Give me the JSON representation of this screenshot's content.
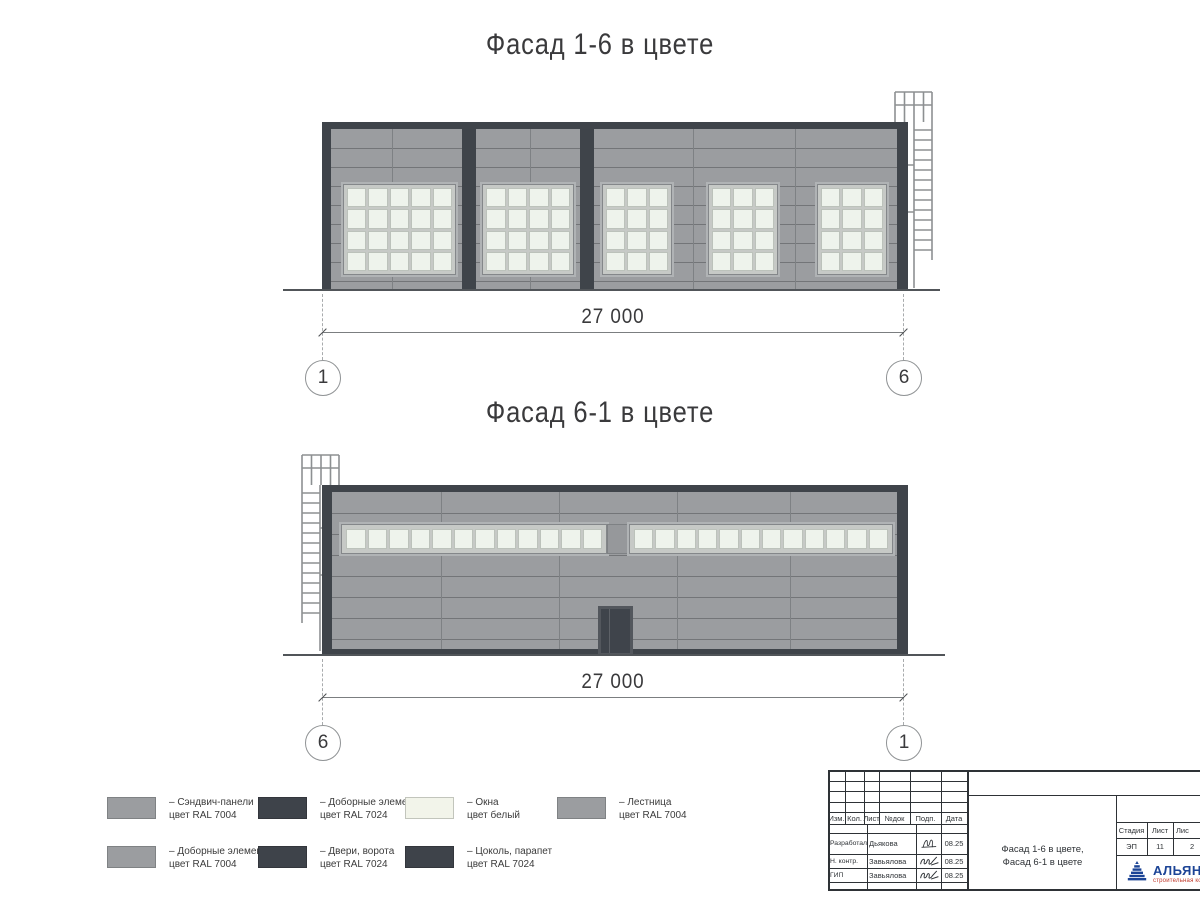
{
  "colors": {
    "ral7004": "#9b9da0",
    "ral7024": "#3f444a",
    "window_white": "#eef3ec",
    "logo_blue": "#1c4496",
    "logo_red": "#c0392b"
  },
  "facades": [
    {
      "title": "Фасад 1-6 в цвете",
      "dimension": "27 000",
      "axis_left": "1",
      "axis_right": "6"
    },
    {
      "title": "Фасад 6-1 в цвете",
      "dimension": "27 000",
      "axis_left": "6",
      "axis_right": "1"
    }
  ],
  "legend": {
    "items": [
      {
        "swatch": "gray",
        "line1": "– Сэндвич-панели",
        "line2": "цвет RAL 7004"
      },
      {
        "swatch": "darksw",
        "line1": "– Доборные элементы",
        "line2": "цвет RAL 7024"
      },
      {
        "swatch": "whitesw",
        "line1": "– Окна",
        "line2": "цвет белый"
      },
      {
        "swatch": "gray",
        "line1": "– Лестница",
        "line2": "цвет RAL 7004"
      },
      {
        "swatch": "gray",
        "line1": "– Доборные элементы",
        "line2": "цвет RAL 7004"
      },
      {
        "swatch": "darksw",
        "line1": "– Двери, ворота",
        "line2": "цвет RAL 7024"
      },
      {
        "swatch": "darksw",
        "line1": "– Цоколь, парапет",
        "line2": "цвет RAL 7024"
      }
    ]
  },
  "title_block": {
    "header_cols": [
      "Изм.",
      "Кол.",
      "Лист",
      "№док",
      "Подп.",
      "Дата"
    ],
    "staff": [
      {
        "role": "Разработал",
        "name": "Дьякова",
        "date": "08.25"
      },
      {
        "role": "Н. контр.",
        "name": "Завьялова",
        "date": "08.25"
      },
      {
        "role": "ГИП",
        "name": "Завьялова",
        "date": "08.25"
      }
    ],
    "doc_title_line1": "Фасад 1-6 в цвете,",
    "doc_title_line2": "Фасад 6-1 в цвете",
    "stage_label": "Стадия",
    "sheet_label": "Лист",
    "sheets_label": "Лис",
    "stage_value": "ЭП",
    "sheet_value": "11",
    "sheets_value": "2",
    "logo_text": "АЛЬЯН",
    "logo_subtext": "строительная комп"
  }
}
